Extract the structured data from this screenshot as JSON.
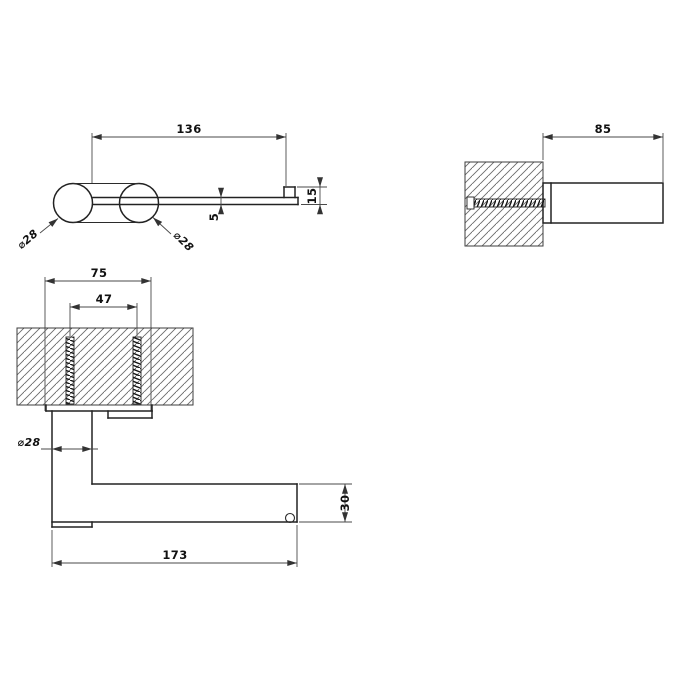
{
  "page": {
    "background": "#ffffff",
    "line_color": "#222222",
    "dim_line_color": "#4a4a4a"
  },
  "views": {
    "top": {
      "label": "top-view-of-holder",
      "dims": {
        "length": "136",
        "thickness": "5",
        "end_depth": "15",
        "post_diameter": "⌀28",
        "roller_diameter": "⌀28"
      }
    },
    "side": {
      "label": "side-view-wall-section",
      "dims": {
        "projection": "85"
      }
    },
    "front": {
      "label": "front-view-wall-section",
      "dims": {
        "plate_width": "75",
        "screw_spacing": "47",
        "post_diameter": "⌀28",
        "arm_height": "30",
        "overall_length": "173"
      }
    }
  }
}
